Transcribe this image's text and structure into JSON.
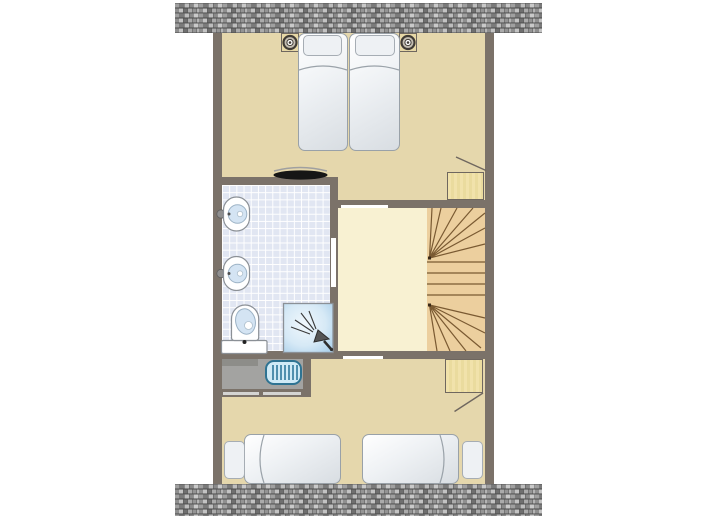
{
  "view": {
    "kind": "floor-plan",
    "visible_text": "none"
  },
  "colors": {
    "background": "#ffffff",
    "wall": "#7b7269",
    "bedroom_floor": "#e5d7ac",
    "hall_floor": "#f8f1d2",
    "bathroom_tile": "#e1e6f2",
    "tile_grid": "#ffffff",
    "closet_floor": "#a3a3a1",
    "shelf": "#8d8d89",
    "stair_wood": "#eccf9e",
    "stair_line": "#7a5a32",
    "wood_block": "#f1e2ab",
    "wood_block_border": "#6f675f",
    "bed_border": "#99a1a8",
    "pillow": "#eef1f4",
    "fixture_outline": "#8b9096",
    "basin_blue": "#d4e4f3",
    "appliance_blue": "#cfeaf6",
    "appliance_border": "#2e7392",
    "door_gap": "#ffffff",
    "louver_door": "#d4d4d2",
    "black_fixture": "#161616",
    "brick_dark": "#4a4a4a",
    "brick_mid": "#8f8f8f",
    "brick_light": "#c9c9c9"
  },
  "plan": {
    "hatch_bands": [
      "roof-hatch-top",
      "roof-hatch-bottom"
    ],
    "rooms": [
      {
        "id": "top-bedroom",
        "type": "bedroom",
        "single_beds": 2,
        "nightstands": 2,
        "lamps": 2,
        "extras": [
          "dark-console",
          "built-in-closet-with-sloped-line"
        ]
      },
      {
        "id": "bathroom",
        "type": "bathroom",
        "washbasins": 2,
        "toilet": 1,
        "shower": 1,
        "door_openings": 1
      },
      {
        "id": "landing",
        "type": "stair-hall",
        "staircase": "winder-staircase",
        "door_openings": 2
      },
      {
        "id": "utility-closet",
        "type": "storage",
        "appliances": 1,
        "shelves": 1,
        "louver_doors": 2
      },
      {
        "id": "bottom-bedroom",
        "type": "bedroom",
        "single_beds": 2,
        "extras": [
          "built-in-closet-with-sloped-line"
        ]
      }
    ]
  }
}
